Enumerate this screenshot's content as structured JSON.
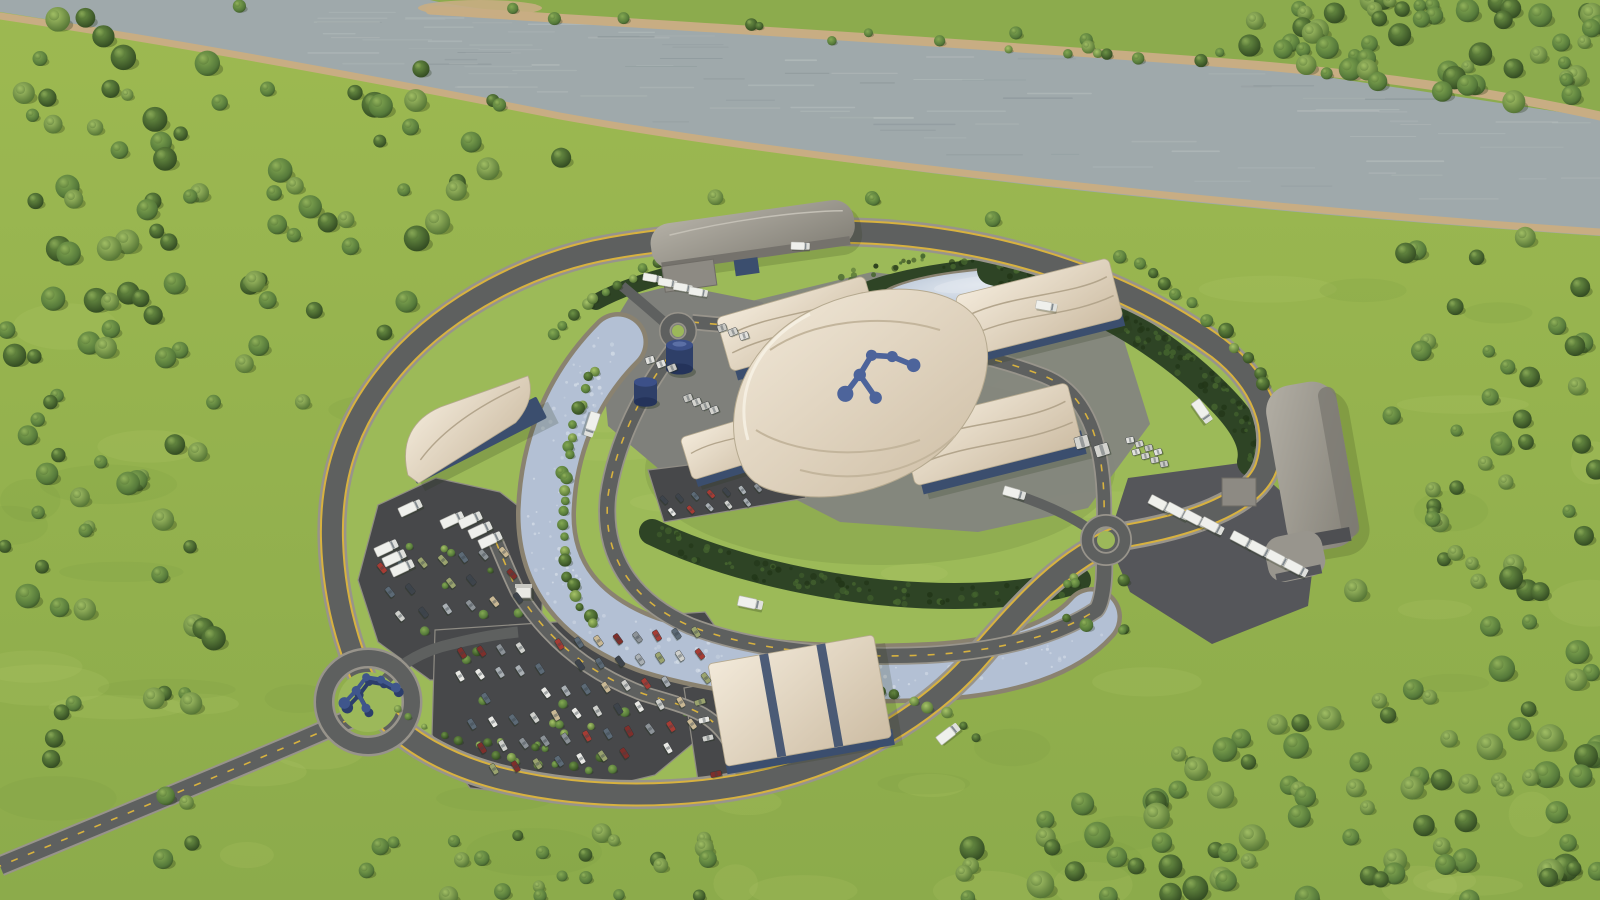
{
  "scene": {
    "title": "aerial-rendering-of-circular-smr-plant-campus-beside-river",
    "elements": [
      "river",
      "far-riverbank-forest",
      "near-bank-forest",
      "meadow",
      "outer-ring-road",
      "access-road",
      "roundabouts",
      "logo-sculpture",
      "cooling-canal",
      "retention-pond",
      "hedge-crescents",
      "central-canopy-building",
      "molecule-roof-logo",
      "glass-atrium",
      "canopy-warehouses",
      "grey-vaulted-warehouses",
      "storage-tanks",
      "container-stacks",
      "parking-lots",
      "cars",
      "trucks",
      "gate-booth",
      "tree-rows"
    ]
  },
  "colors": {
    "meadow": "#94b150",
    "meadowLight": "#b4cc6c",
    "lawn": "#9cba58",
    "forest": "#3f5d2b",
    "forestDark": "#2b421d",
    "hedge": "#2e4425",
    "hedgeDark": "#223618",
    "hedgeLight": "#46662f",
    "river": "#9fa9ab",
    "riverLight": "#c3cac8",
    "riverDark": "#7d898d",
    "sand": "#c8ad83",
    "sandDark": "#a98f66",
    "road": "#5e605f",
    "roadKerb": "#98948b",
    "parking": "#47484a",
    "yellowLine": "#d8b23f",
    "canal": "#b3c0d4",
    "canalLight": "#dfe6ee",
    "canalEdge": "#8a8270",
    "pond": "#b9c6d7",
    "pondLight": "#e2e8ef",
    "canopyLight": "#f2e9d9",
    "canopyShade": "#cdbda4",
    "canopySeam": "#b3a58c",
    "baseBlue": "#3b4e6e",
    "baseBlueDark": "#2b3a55",
    "glass": "#333f4a",
    "glassLine": "#dfe3e6",
    "greyRoofLight": "#b3afa5",
    "greyRoofDark": "#827f76",
    "logoBlue": "#4d649b",
    "sculpture": "#3f568c",
    "sculptureDark": "#2c3e6b",
    "tankBlue": "#2e3f68",
    "truckWhite": "#eff0ec",
    "truckCab": "#dfe0dc",
    "booth": "#e9e9e4",
    "padGrey": "#84857f",
    "yardGrey": "#7f807b",
    "darkYard": "#55565a",
    "shadow": "#1c2b10"
  },
  "car_palette": [
    "#e9e9e5",
    "#cfd0cc",
    "#aab0b4",
    "#8c9297",
    "#a63c34",
    "#7e2f2b",
    "#c9b894",
    "#9aa36e",
    "#5c6a76",
    "#3e444b"
  ],
  "container_palette": [
    "#e2e2de",
    "#d4d4cf",
    "#c9c9c4"
  ],
  "logo": {
    "nodes": [
      [
        10,
        62
      ],
      [
        40,
        38
      ],
      [
        66,
        12
      ],
      [
        98,
        22
      ],
      [
        128,
        44
      ],
      [
        56,
        80
      ]
    ],
    "radii": [
      13,
      10,
      9,
      9,
      11,
      10
    ],
    "links": [
      [
        0,
        1
      ],
      [
        1,
        2
      ],
      [
        2,
        3
      ],
      [
        3,
        4
      ],
      [
        1,
        5
      ]
    ]
  }
}
